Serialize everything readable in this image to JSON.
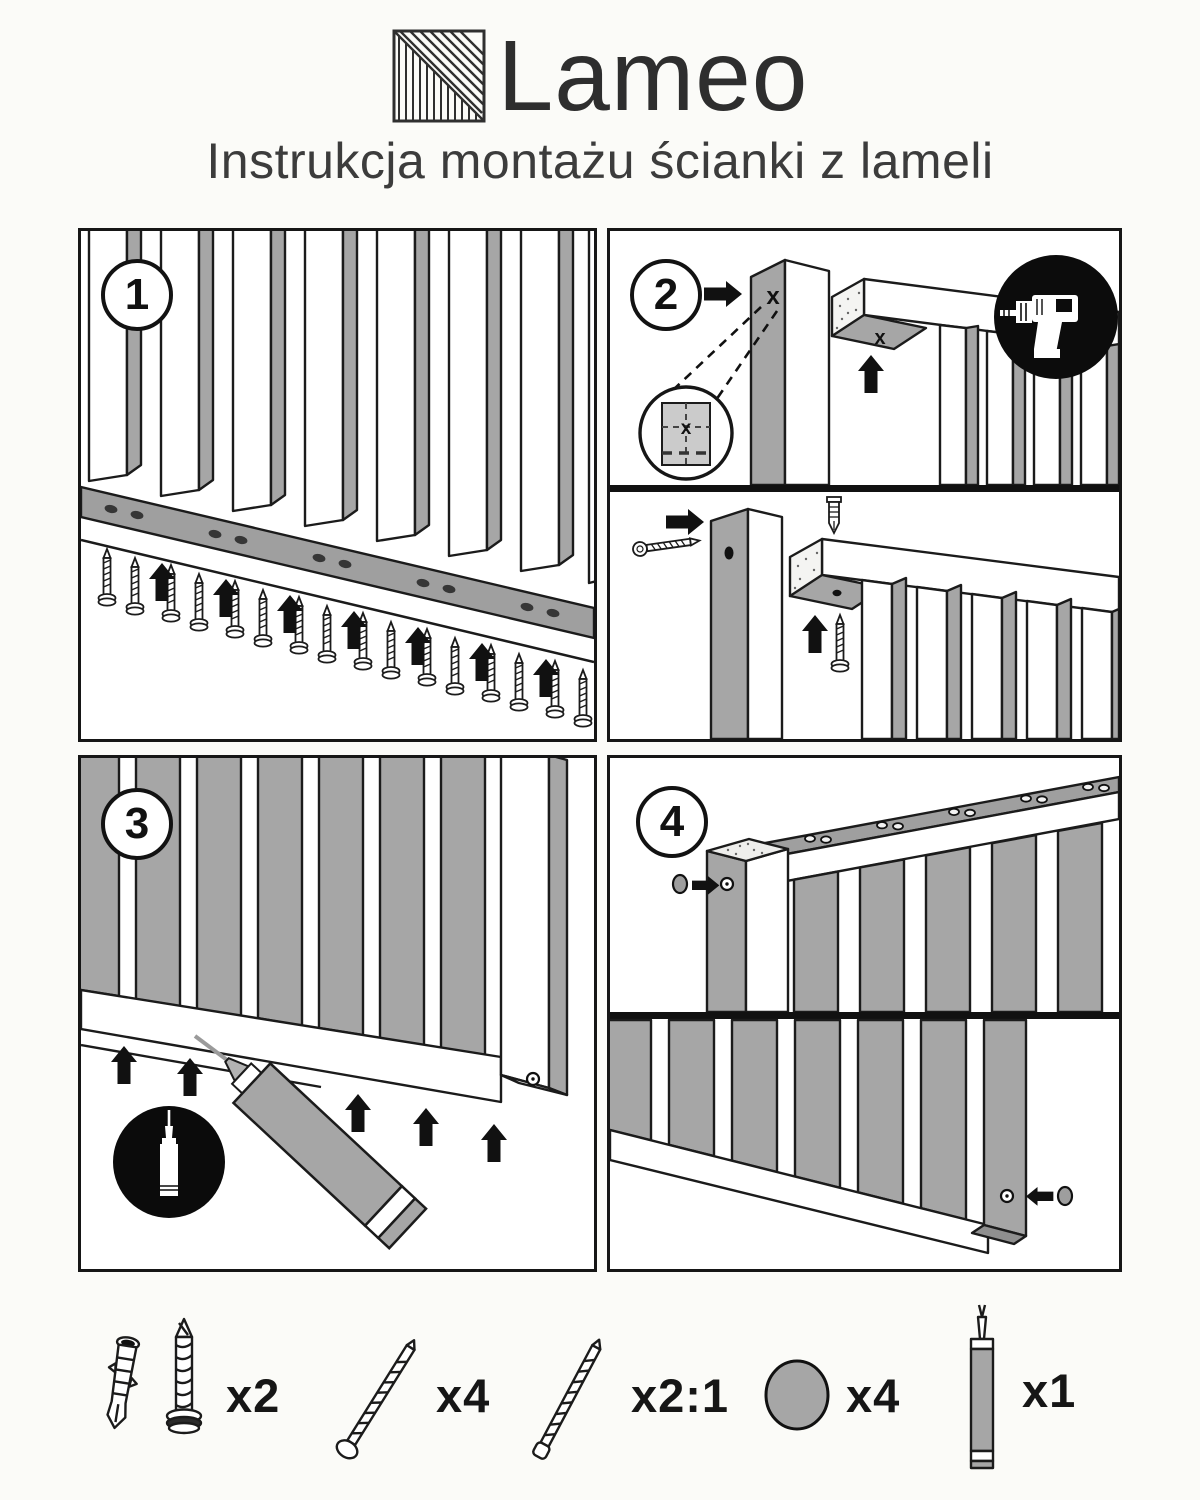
{
  "header": {
    "brand": "Lameo",
    "subtitle": "Instrukcja montażu ścianki z lameli"
  },
  "steps": [
    {
      "number": "1"
    },
    {
      "number": "2"
    },
    {
      "number": "3"
    },
    {
      "number": "4"
    }
  ],
  "marks": {
    "cross": "x"
  },
  "parts": [
    {
      "name": "wall-plug-with-screw",
      "qty": "x2"
    },
    {
      "name": "mounting-screw",
      "qty": "x4"
    },
    {
      "name": "slat-screw",
      "qty": "x2:1"
    },
    {
      "name": "cover-cap",
      "qty": "x4"
    },
    {
      "name": "sealant-tube",
      "qty": "x1"
    }
  ],
  "colors": {
    "background": "#fbfbf8",
    "ink": "#1b1b1b",
    "slat_gray": "#a6a6a6",
    "text": "#3c3c3c"
  }
}
